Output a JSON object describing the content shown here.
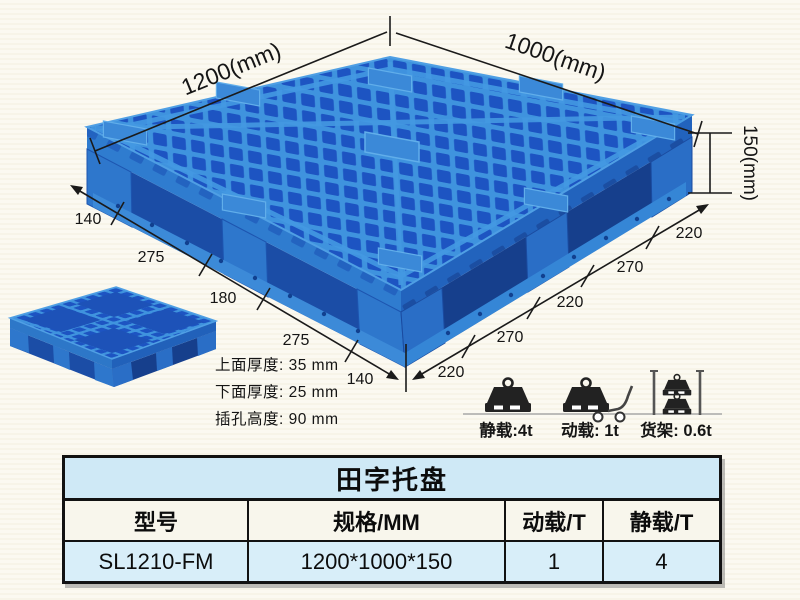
{
  "illustration": {
    "top_left_dim": "1200(mm)",
    "top_right_dim": "1000(mm)",
    "height_dim": "150(mm)",
    "left_segments": [
      "140",
      "275",
      "180",
      "275",
      "140"
    ],
    "right_segments": [
      "220",
      "270",
      "220",
      "270",
      "220"
    ],
    "notes": {
      "top_thickness": "上面厚度: 35 mm",
      "bottom_thickness": "下面厚度: 25 mm",
      "slot_height": "插孔高度: 90 mm"
    }
  },
  "loads": {
    "static_label": "静载:4t",
    "dynamic_label": "动载: 1t",
    "rack_label": "货架: 0.6t"
  },
  "table": {
    "title": "田字托盘",
    "headers": [
      "型号",
      "规格/MM",
      "动载/T",
      "静载/T"
    ],
    "row": [
      "SL1210-FM",
      "1200*1000*150",
      "1",
      "4"
    ]
  },
  "colors": {
    "pallet_light": "#4499e2",
    "pallet_mid": "#2f7ccf",
    "pallet_dark_face": "#2263bd",
    "pallet_hole": "#1d54c2",
    "pallet_shadow": "#1b4da6",
    "table_title_bg": "#cfe9f6",
    "table_header_bg": "#f8f6ec",
    "table_row_bg": "#d8eef9",
    "line_color": "#1a1a1a"
  }
}
